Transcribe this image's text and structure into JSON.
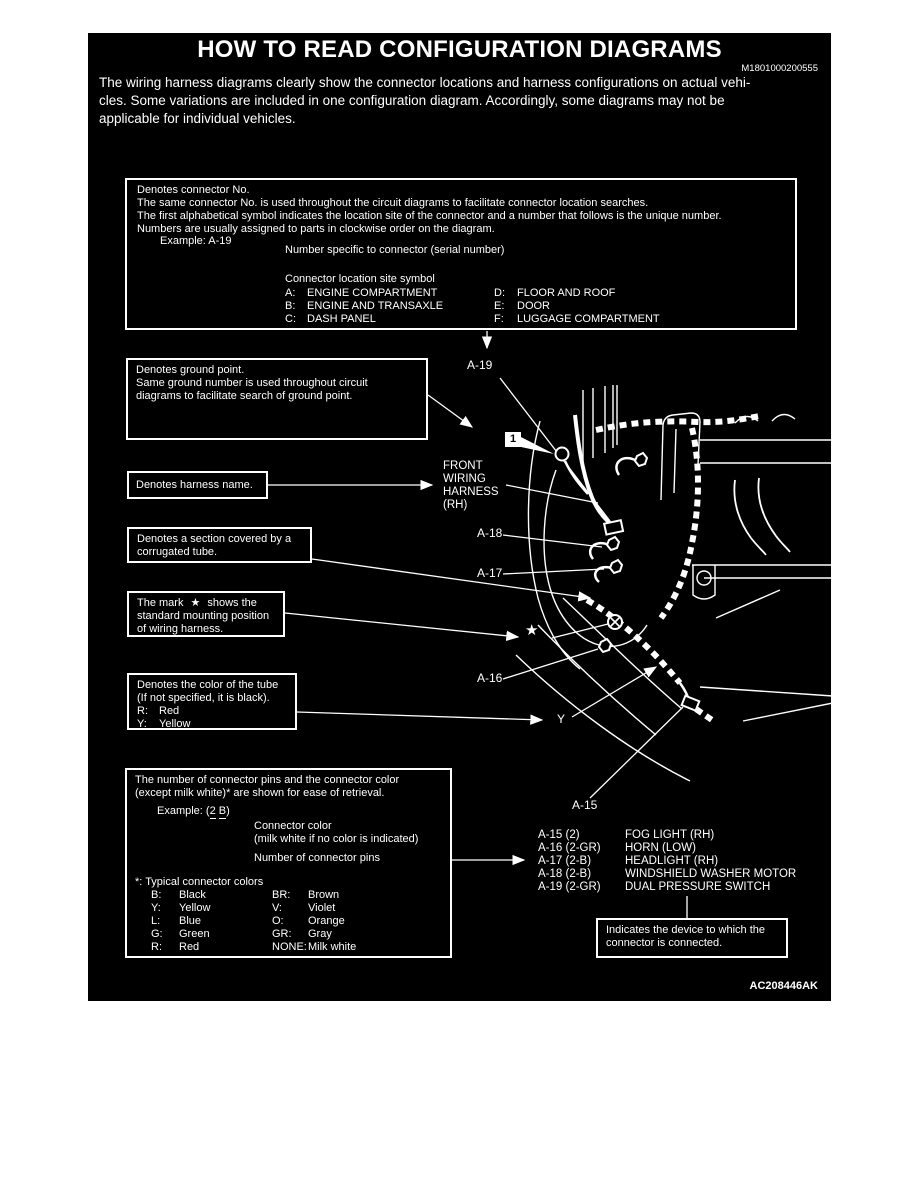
{
  "page": {
    "title": "HOW TO READ CONFIGURATION DIAGRAMS",
    "doc_number": "M1801000200555",
    "intro_lines": [
      "The wiring harness diagrams clearly show the connector locations and harness configurations on actual vehi-",
      "cles. Some variations are included in one configuration diagram. Accordingly, some diagrams may not be",
      "applicable for individual vehicles."
    ],
    "figure_code": "AC208446AK"
  },
  "connector_note_box": {
    "lines": [
      "Denotes connector No.",
      "The same connector No. is used throughout the circuit diagrams to facilitate connector location searches.",
      "The first alphabetical symbol indicates the location site of the connector and a number that follows is the unique number.",
      "Numbers are usually assigned to parts in clockwise order on the diagram."
    ],
    "example_label": "Example: A-19",
    "serial_note": "Number specific to connector (serial number)",
    "site_note": "Connector location site symbol",
    "site_col1": [
      {
        "code": "A:",
        "name": "ENGINE COMPARTMENT"
      },
      {
        "code": "B:",
        "name": "ENGINE AND TRANSAXLE"
      },
      {
        "code": "C:",
        "name": "DASH PANEL"
      }
    ],
    "site_col2": [
      {
        "code": "D:",
        "name": "FLOOR AND ROOF"
      },
      {
        "code": "E:",
        "name": "DOOR"
      },
      {
        "code": "F:",
        "name": "LUGGAGE COMPARTMENT"
      }
    ]
  },
  "ground_box": {
    "lines": [
      "Denotes ground point.",
      "Same ground number is used throughout circuit",
      "diagrams to facilitate search of ground point."
    ]
  },
  "harness_box": {
    "label": "Denotes harness name."
  },
  "corrugated_box": {
    "lines": [
      "Denotes a section covered by a",
      "corrugated tube."
    ]
  },
  "star_box": {
    "line1_pre": "The mark",
    "star": "★",
    "line1_post": "shows the",
    "line2": "standard mounting position",
    "line3": "of wiring harness."
  },
  "tube_box": {
    "lines": [
      "Denotes the color of the tube",
      "(If not specified, it is black)."
    ],
    "colors": [
      {
        "code": "R:",
        "name": "Red"
      },
      {
        "code": "Y:",
        "name": "Yellow"
      }
    ]
  },
  "pins_box": {
    "lines": [
      "The number of connector pins and the connector color",
      "(except milk white)* are shown for ease of retrieval."
    ],
    "example_prefix": "Example: (",
    "example_pins": "2",
    "example_color": "B",
    "example_suffix": ")",
    "color_note1": "Connector color",
    "color_note2": "(milk white if no color is indicated)",
    "pins_note": "Number of connector pins",
    "legend_title": "*: Typical connector colors",
    "legend": [
      {
        "c1": "B:",
        "n1": "Black",
        "c2": "BR:",
        "n2": "Brown"
      },
      {
        "c1": "Y:",
        "n1": "Yellow",
        "c2": "V:",
        "n2": "Violet"
      },
      {
        "c1": "L:",
        "n1": "Blue",
        "c2": "O:",
        "n2": "Orange"
      },
      {
        "c1": "G:",
        "n1": "Green",
        "c2": "GR:",
        "n2": "Gray"
      },
      {
        "c1": "R:",
        "n1": "Red",
        "c2": "NONE:",
        "n2": "Milk white"
      }
    ]
  },
  "device_box": {
    "lines": [
      "Indicates the device to which the",
      "connector is connected."
    ]
  },
  "diagram": {
    "ground_number": "1",
    "harness_name_lines": [
      "FRONT",
      "WIRING",
      "HARNESS",
      "(RH)"
    ],
    "labels": {
      "a19": "A-19",
      "a18": "A-18",
      "a17": "A-17",
      "a16": "A-16",
      "a15": "A-15",
      "y": "Y",
      "star": "★"
    }
  },
  "connector_list": [
    {
      "id": "A-15 (2)",
      "device": "FOG LIGHT (RH)"
    },
    {
      "id": "A-16 (2-GR)",
      "device": "HORN (LOW)"
    },
    {
      "id": "A-17 (2-B)",
      "device": "HEADLIGHT (RH)"
    },
    {
      "id": "A-18 (2-B)",
      "device": "WINDSHIELD WASHER MOTOR"
    },
    {
      "id": "A-19 (2-GR)",
      "device": "DUAL PRESSURE SWITCH"
    }
  ]
}
